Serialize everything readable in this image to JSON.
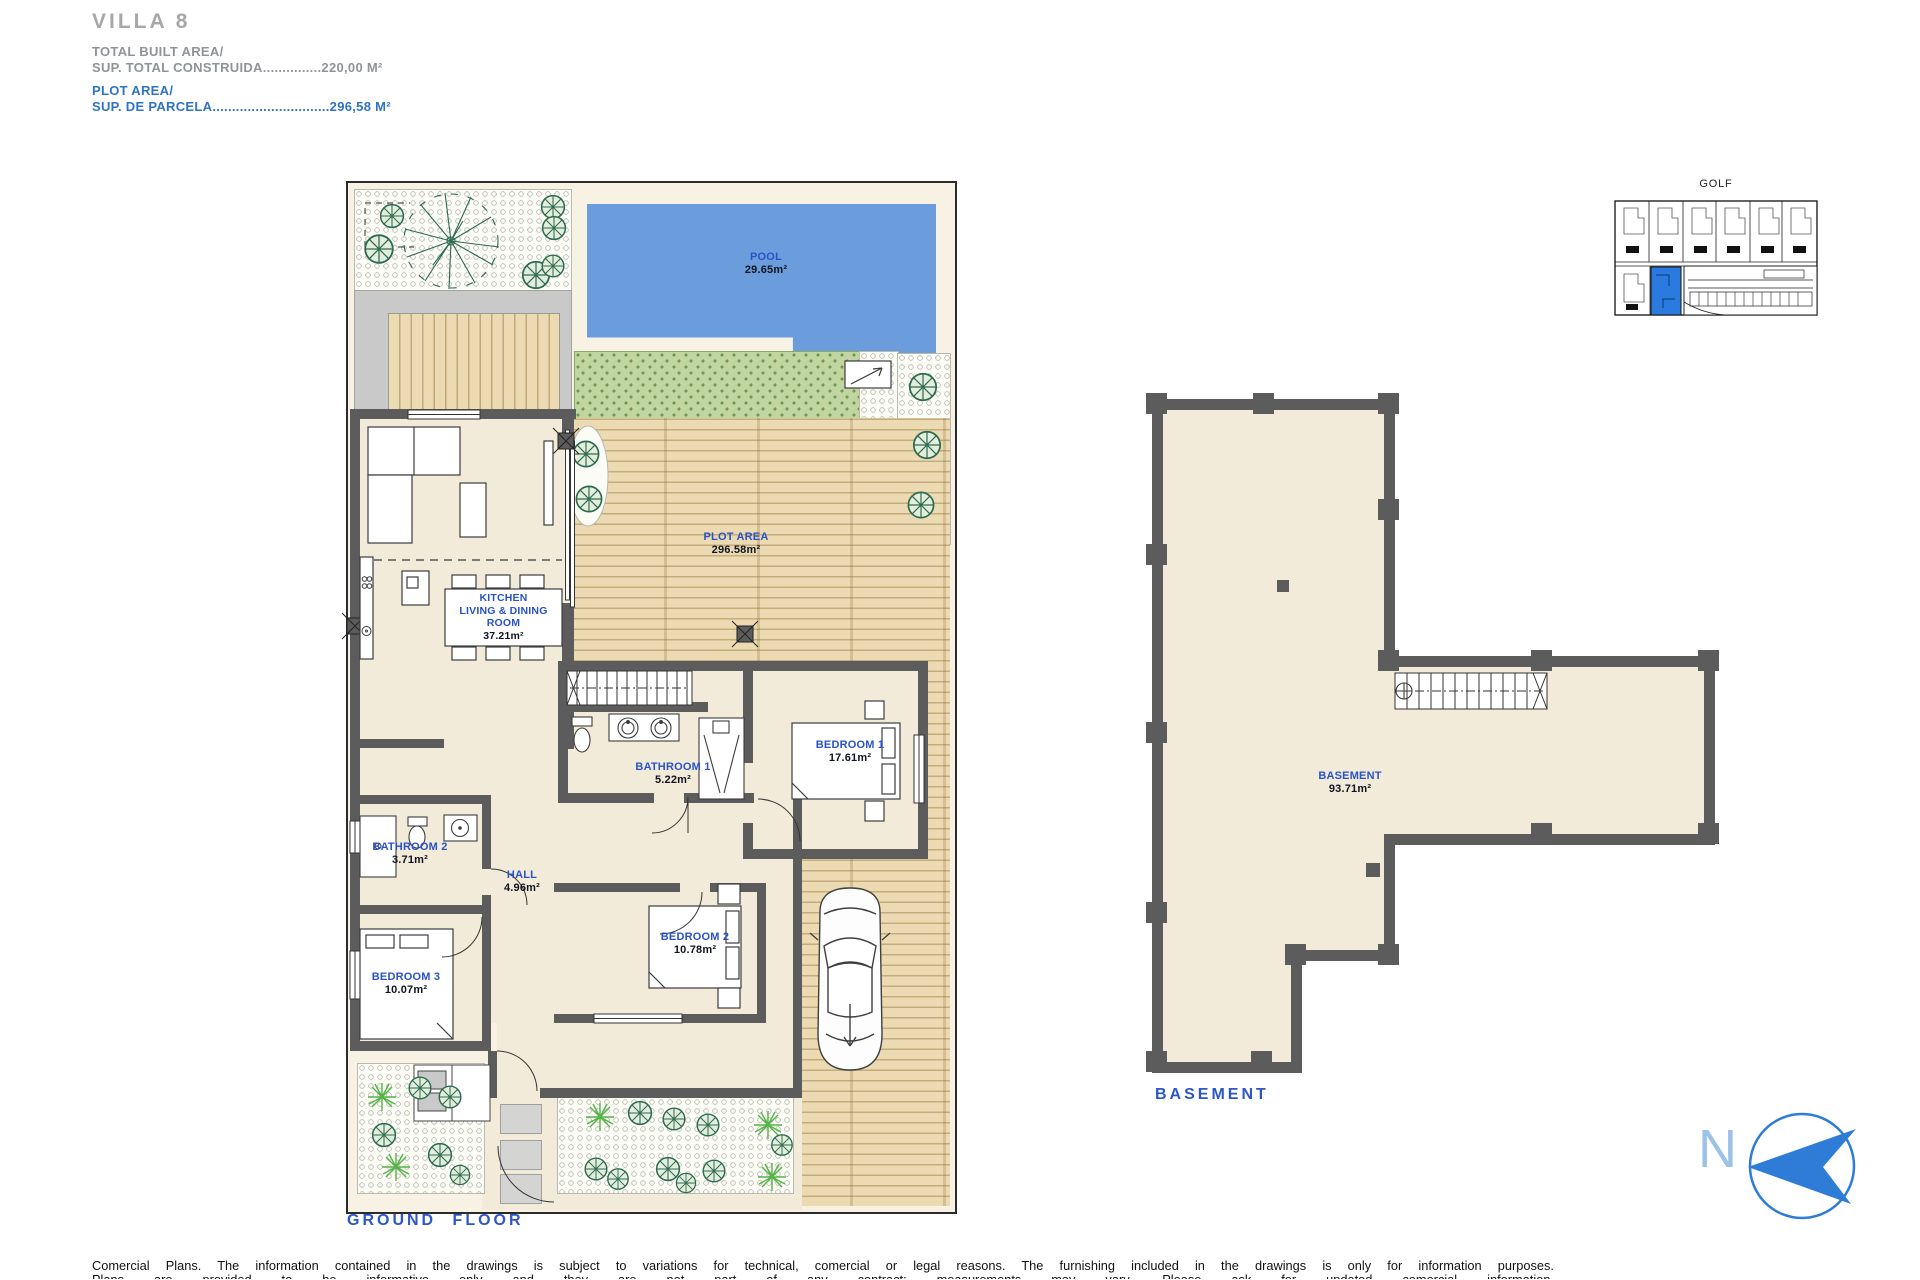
{
  "header": {
    "title": "VILLA 8",
    "built_label": "TOTAL BUILT AREA/",
    "built_value": "SUP. TOTAL CONSTRUIDA...............220,00 M²",
    "plot_label": "PLOT AREA/",
    "plot_value": "SUP. DE PARCELA..............................296,58 M²"
  },
  "ground_floor": {
    "caption": "GROUND FLOOR",
    "pool": {
      "name": "POOL",
      "area": "29.65m²"
    },
    "plot": {
      "name": "PLOT AREA",
      "area": "296.58m²"
    },
    "kitchen": {
      "name_line1": "KITCHEN",
      "name_line2": "LIVING & DINING",
      "name_line3": "ROOM",
      "area": "37.21m²"
    },
    "bathroom1": {
      "name": "BATHROOM 1",
      "area": "5.22m²"
    },
    "bedroom1": {
      "name": "BEDROOM 1",
      "area": "17.61m²"
    },
    "bathroom2": {
      "name": "BATHROOM 2",
      "area": "3.71m²"
    },
    "hall": {
      "name": "HALL",
      "area": "4.96m²"
    },
    "bedroom2": {
      "name": "BEDROOM 2",
      "area": "10.78m²"
    },
    "bedroom3": {
      "name": "BEDROOM 3",
      "area": "10.07m²"
    }
  },
  "basement": {
    "caption": "BASEMENT",
    "label": {
      "name": "BASEMENT",
      "area": "93.71m²"
    }
  },
  "key_plan": {
    "title": "GOLF"
  },
  "compass": {
    "letter": "N"
  },
  "footer": {
    "line1": "Comercial Plans. The information contained in the drawings is subject to variations for technical, comercial or legal reasons. The furnishing included in the drawings is only for information purposes.",
    "line2": "Plans are provided to be informative only and they are not part of any contract; measurements may vary. Please ask for updated comercial information."
  },
  "colors": {
    "accent_blue": "#2a52c8",
    "header_gray": "#8f9499",
    "header_blue": "#2f74c4",
    "pool_fill": "#6b9ddd",
    "highlight_unit": "#2b7ae0",
    "wall": "#5c5c5c",
    "deck": "#ecdbb2",
    "grass": "#c0d59f"
  }
}
